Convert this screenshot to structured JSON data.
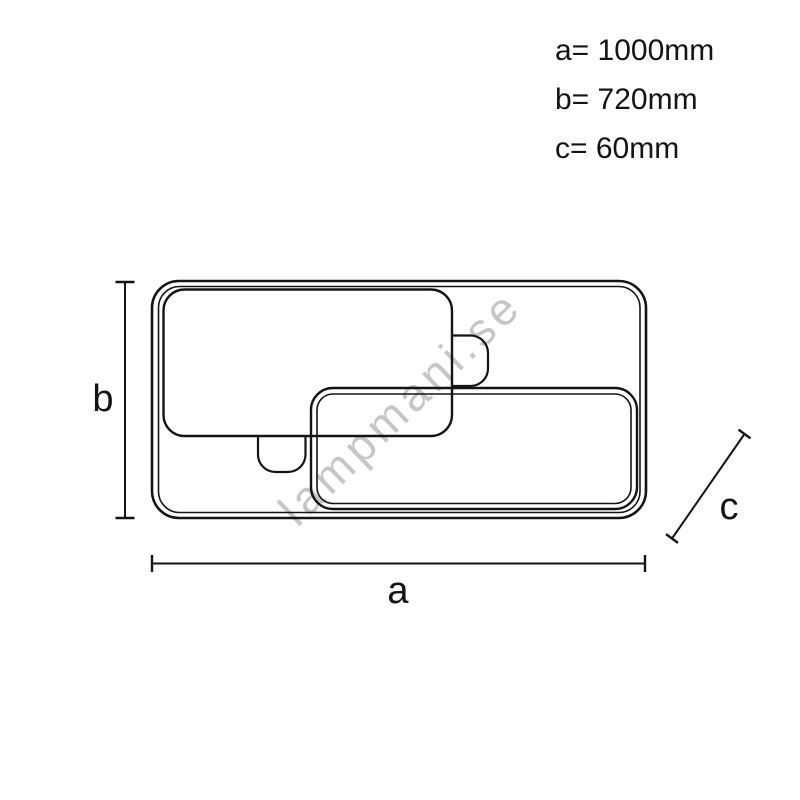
{
  "diagram": {
    "description": "Ceiling lamp dimension drawing, front view with three overlapping rounded rectangular panels",
    "watermark": {
      "text": "lampmani.se"
    },
    "spec_list": [
      {
        "label": "a",
        "text": "a= 1000mm",
        "value_mm": 1000
      },
      {
        "label": "b",
        "text": "b= 720mm",
        "value_mm": 720
      },
      {
        "label": "c",
        "text": "c= 60mm",
        "value_mm": 60
      }
    ],
    "dim_labels": {
      "a": "a",
      "b": "b",
      "c": "c"
    },
    "colors": {
      "line": "#141414",
      "watermark": "#c6c6c6",
      "background": "#ffffff"
    }
  }
}
